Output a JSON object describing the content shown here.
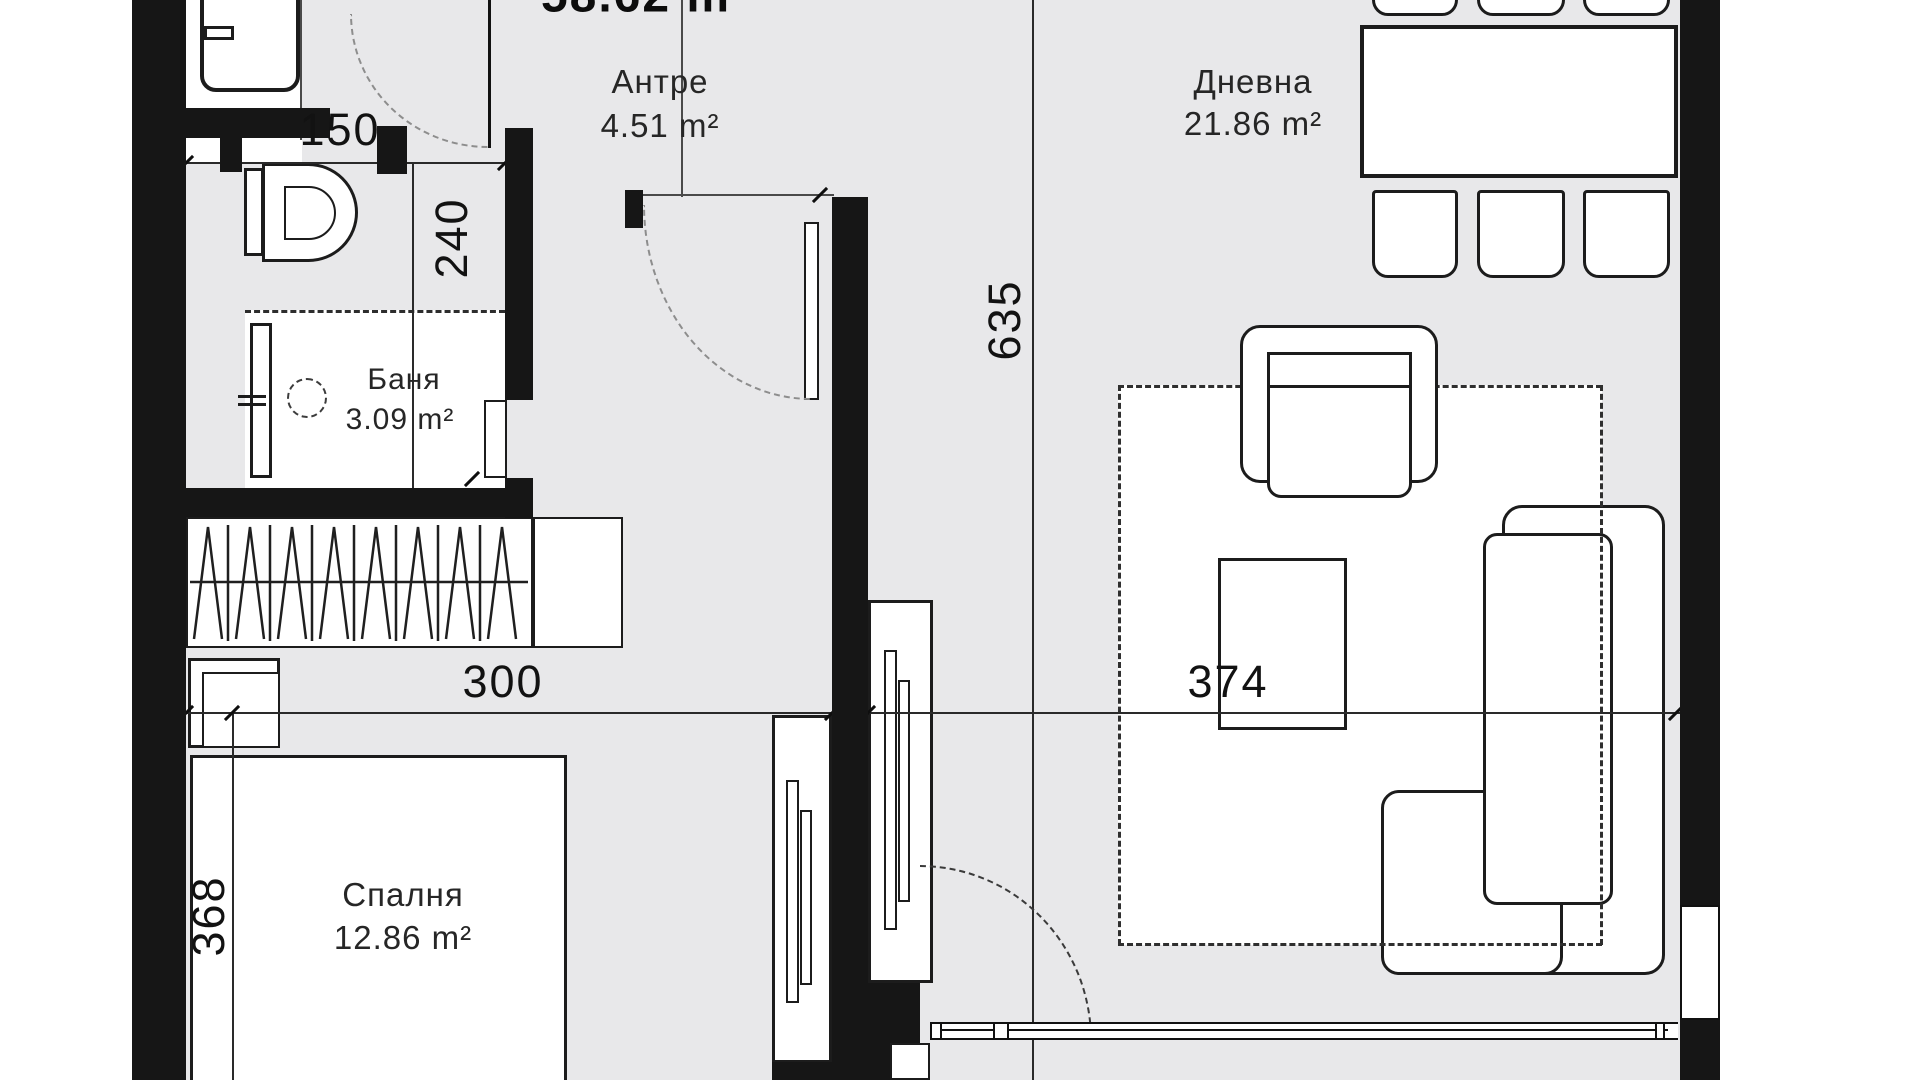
{
  "title": "Apartment floor plan",
  "total_area": {
    "label": "58.62 m²"
  },
  "rooms": {
    "antre": {
      "name": "Антре",
      "area": "4.51 m²"
    },
    "dnevna": {
      "name": "Дневна",
      "area": "21.86 m²"
    },
    "banya": {
      "name": "Баня",
      "area": "3.09 m²"
    },
    "spalnya": {
      "name": "Спалня",
      "area": "12.86 m²"
    }
  },
  "dimensions": {
    "bath_width": "150",
    "bath_depth": "240",
    "hall_length": "635",
    "bedroom_width": "300",
    "living_width": "374",
    "bedroom_depth": "368"
  },
  "colors": {
    "wall": "#161616",
    "floor": "#e8e8ea",
    "line": "#2a2a2a",
    "fixture_fill": "#ffffff"
  }
}
